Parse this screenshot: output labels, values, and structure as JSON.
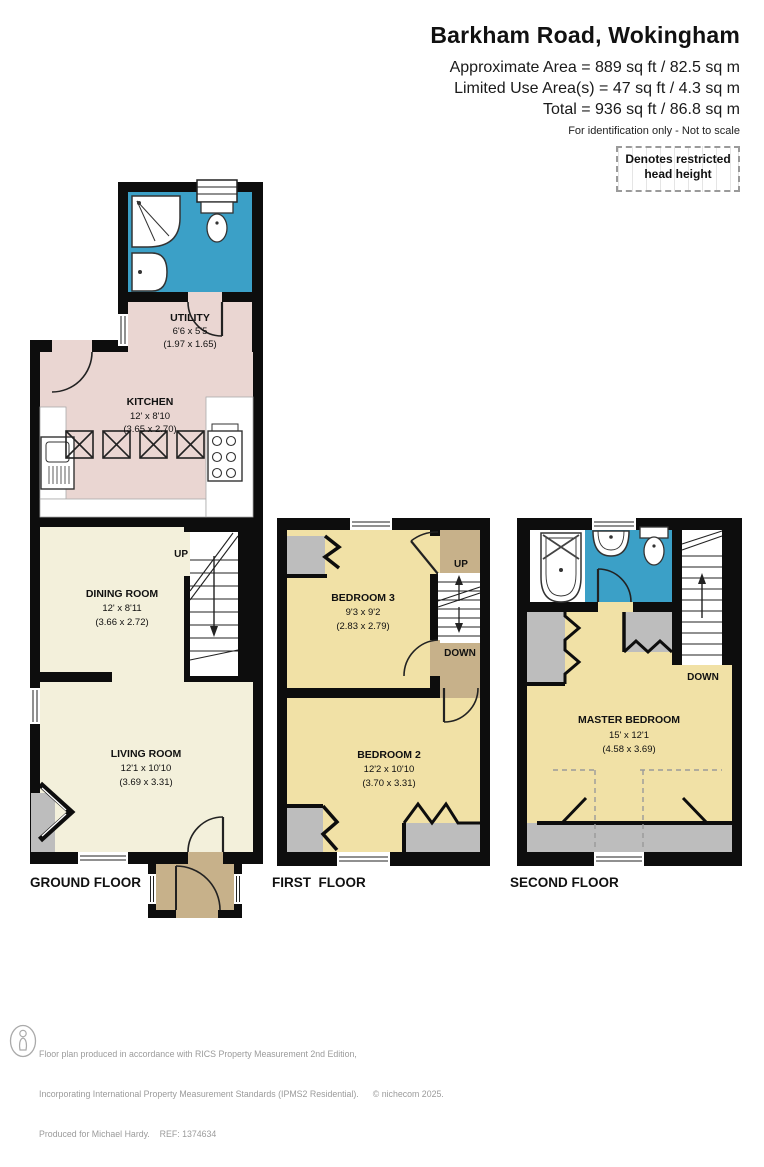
{
  "header": {
    "title": "Barkham Road, Wokingham",
    "area_line1": "Approximate Area = 889 sq ft / 82.5 sq m",
    "area_line2": "Limited Use Area(s) = 47 sq ft / 4.3 sq m",
    "area_line3": "Total = 936 sq ft / 86.8 sq m",
    "disclaimer": "For identification only - Not to scale",
    "legend": "Denotes restricted head height"
  },
  "floors": {
    "ground": {
      "label": "GROUND FLOOR",
      "stairs_up": "UP",
      "rooms": {
        "utility": {
          "name": "UTILITY",
          "imperial": "6'6 x 5'5",
          "metric": "(1.97 x 1.65)"
        },
        "kitchen": {
          "name": "KITCHEN",
          "imperial": "12' x 8'10",
          "metric": "(3.65 x 2.70)"
        },
        "dining": {
          "name": "DINING ROOM",
          "imperial": "12' x 8'11",
          "metric": "(3.66 x 2.72)"
        },
        "living": {
          "name": "LIVING ROOM",
          "imperial": "12'1 x 10'10",
          "metric": "(3.69 x 3.31)"
        }
      }
    },
    "first": {
      "label": "FIRST  FLOOR",
      "stairs_up": "UP",
      "stairs_down": "DOWN",
      "rooms": {
        "bedroom3": {
          "name": "BEDROOM 3",
          "imperial": "9'3 x 9'2",
          "metric": "(2.83 x 2.79)"
        },
        "bedroom2": {
          "name": "BEDROOM 2",
          "imperial": "12'2 x 10'10",
          "metric": "(3.70 x 3.31)"
        }
      }
    },
    "second": {
      "label": "SECOND FLOOR",
      "stairs_down": "DOWN",
      "rooms": {
        "master": {
          "name": "MASTER BEDROOM",
          "imperial": "15' x 12'1",
          "metric": "(4.58 x 3.69)"
        }
      }
    }
  },
  "footer": {
    "line1": "Floor plan produced in accordance with RICS Property Measurement 2nd Edition,",
    "line2": "Incorporating International Property Measurement Standards (IPMS2 Residential).",
    "copyright": "© nichecom 2025.",
    "line3": "Produced for Michael Hardy.    REF: 1374634"
  },
  "colors": {
    "bathroom_blue": "#3BA0C7",
    "kitchen_pink": "#EAD6D2",
    "reception_cream": "#F3F0DB",
    "bedroom_yellow": "#F1E1A6",
    "landing_tan": "#C7B18A",
    "alcove_gray": "#BDBDBD",
    "wall_black": "#0D0D0D"
  }
}
